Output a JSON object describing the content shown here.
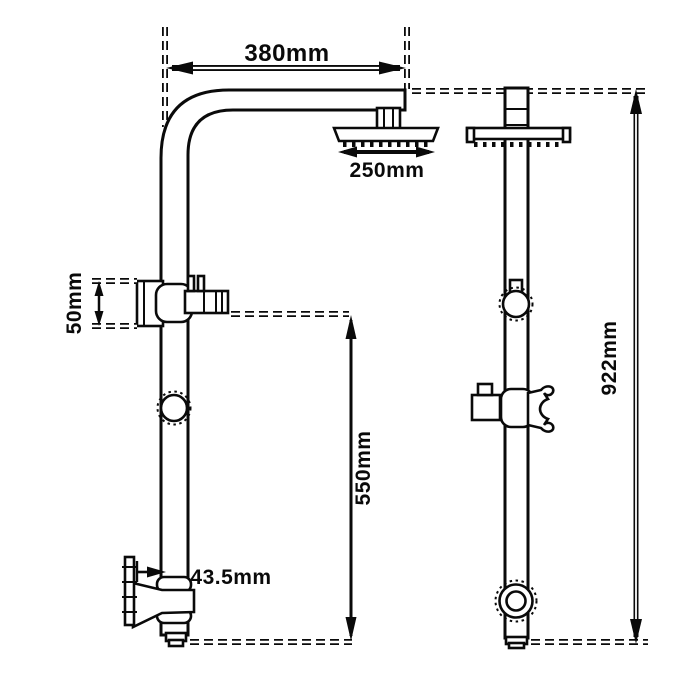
{
  "diagram": {
    "type": "technical-dimension-drawing",
    "subject": "twin rail shower column shown in side view and front view with millimetre dimensions",
    "background_color": "#ffffff",
    "line_color": "#0a0a0a",
    "dimensions": {
      "top_arm_width": "380mm",
      "shower_head_width": "250mm",
      "wall_bracket_height": "50mm",
      "lower_rail_length": "550mm",
      "bottom_wall_offset": "43.5mm",
      "overall_height": "922mm"
    }
  }
}
